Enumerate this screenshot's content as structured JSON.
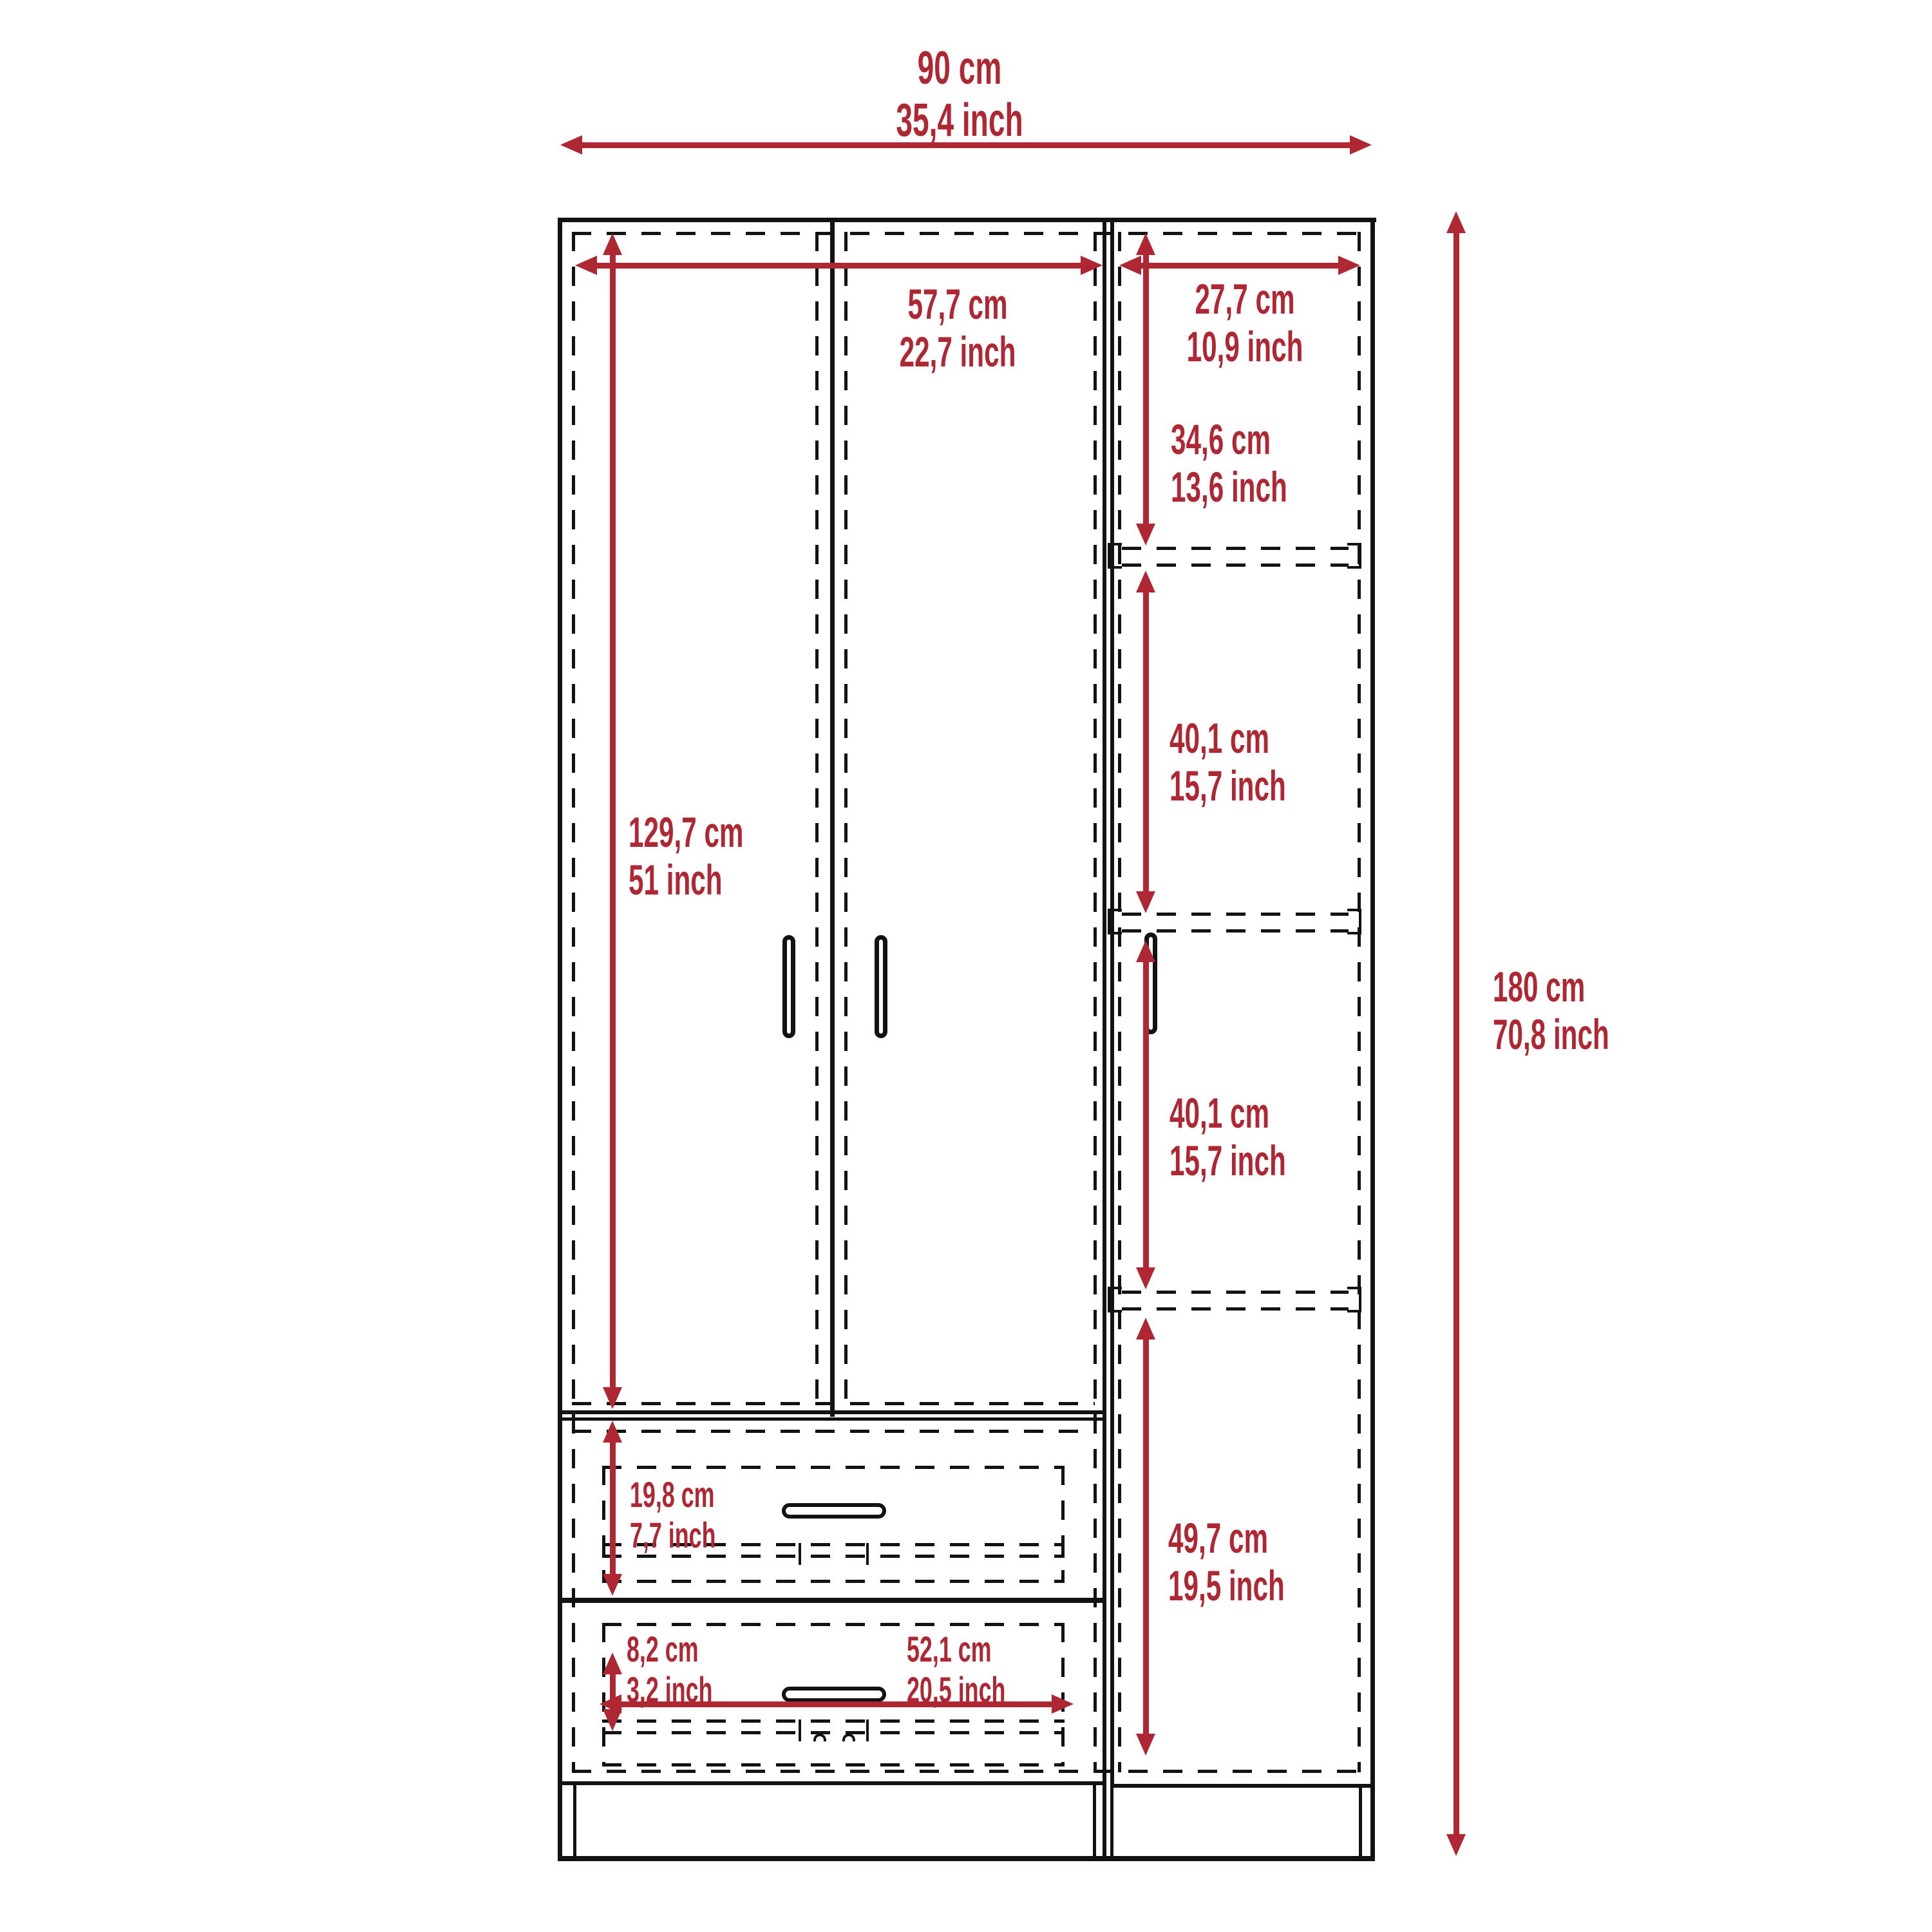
{
  "accent_color": "#AE2733",
  "diagram": {
    "type": "furniture-dimension-drawing",
    "subject": "3-door wardrobe with two drawers and side shelving",
    "dimensions": {
      "overall_width": {
        "cm": "90 cm",
        "inch": "35,4 inch"
      },
      "door_section_width": {
        "cm": "57,7 cm",
        "inch": "22,7 inch"
      },
      "side_section_width": {
        "cm": "27,7 cm",
        "inch": "10,9 inch"
      },
      "top_shelf_height": {
        "cm": "34,6 cm",
        "inch": "13,6 inch"
      },
      "middle_shelf_height": {
        "cm": "40,1 cm",
        "inch": "15,7 inch"
      },
      "lower_shelf_height": {
        "cm": "40,1 cm",
        "inch": "15,7 inch"
      },
      "door_height": {
        "cm": "129,7 cm",
        "inch": "51 inch"
      },
      "overall_height": {
        "cm": "180 cm",
        "inch": "70,8 inch"
      },
      "bottom_shelf_height": {
        "cm": "49,7 cm",
        "inch": "19,5 inch"
      },
      "drawer_height": {
        "cm": "19,8 cm",
        "inch": "7,7 inch"
      },
      "drawer_inner_height": {
        "cm": "8,2 cm",
        "inch": "3,2 inch"
      },
      "drawer_width": {
        "cm": "52,1 cm",
        "inch": "20,5 inch"
      }
    }
  }
}
